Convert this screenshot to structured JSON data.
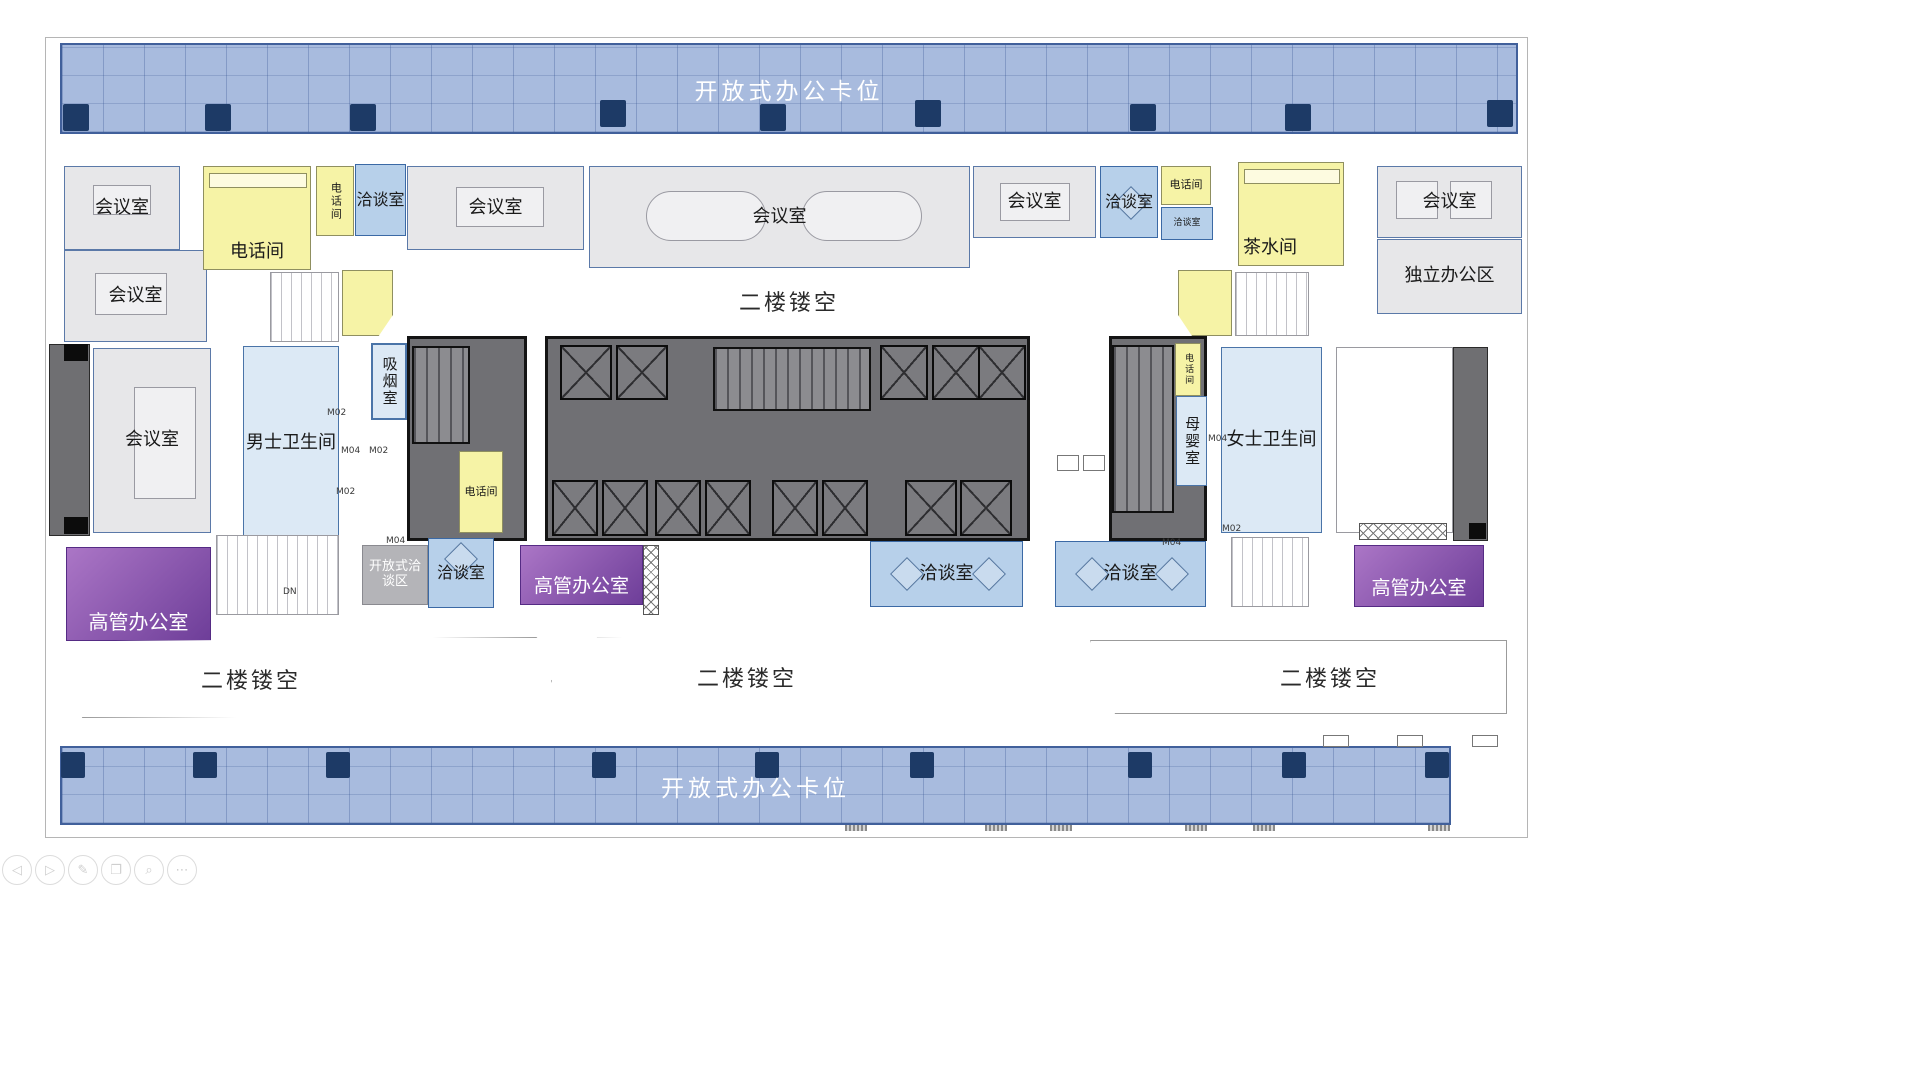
{
  "plan": {
    "open_office_top": "开放式办公卡位",
    "open_office_bottom": "开放式办公卡位",
    "void_label": "二楼镂空",
    "meeting_room": "会议室",
    "phone_room": "电话间",
    "negotiation_room": "洽谈室",
    "pantry": "茶水间",
    "independent_office": "独立办公区",
    "smoking_room": "吸烟室",
    "men_restroom": "男士卫生间",
    "women_restroom": "女士卫生间",
    "nursing_room": "母婴室",
    "executive_office": "高管办公室",
    "open_negotiation_area": "开放式洽谈区",
    "down_label": "DN"
  },
  "door_tags": [
    "M02",
    "M04",
    "M02",
    "M02",
    "M04",
    "M04",
    "M02",
    "M04"
  ],
  "toolbar": {
    "icons": [
      {
        "name": "back",
        "glyph": "◁"
      },
      {
        "name": "forward",
        "glyph": "▷"
      },
      {
        "name": "edit",
        "glyph": "✎"
      },
      {
        "name": "copy",
        "glyph": "❐"
      },
      {
        "name": "zoom",
        "glyph": "⌕"
      },
      {
        "name": "more",
        "glyph": "⋯"
      }
    ]
  },
  "colors": {
    "open_office_fill": "#a8bbde",
    "meeting_fill": "#e7e7e9",
    "negotiation_fill": "#b7d0ea",
    "phone_fill": "#f6f3a6",
    "restroom_fill": "#dce9f5",
    "executive_fill": "#8a55ab",
    "core_fill": "#707074",
    "accent_border": "#3b69a5",
    "desk_navy": "#1d3a66"
  }
}
